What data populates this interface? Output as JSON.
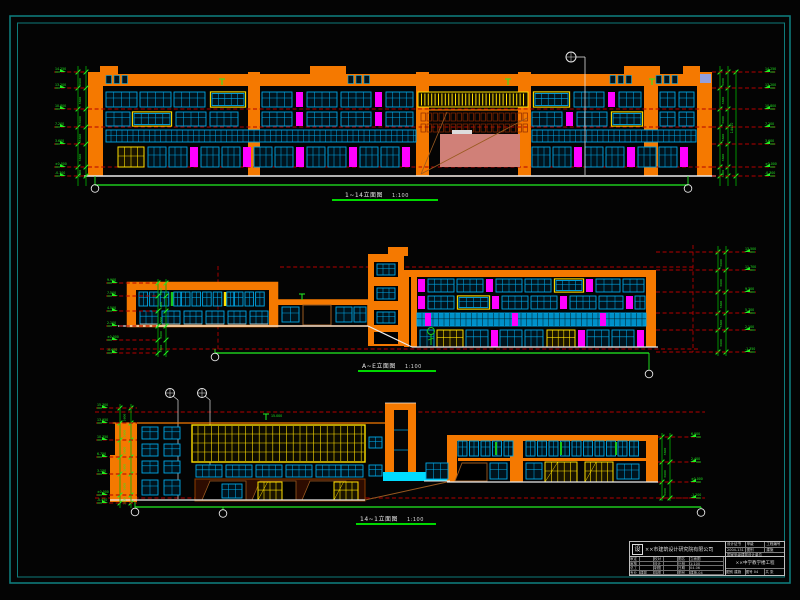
{
  "colors": {
    "orange": "#f57900",
    "cyan": "#00a8e8",
    "cyanBright": "#00dcff",
    "magenta": "#ff00ff",
    "yellow": "#ffe000",
    "green": "#00b400",
    "greenB": "#22ef22",
    "redDash": "#b40000",
    "salmon": "#d08078",
    "brown": "#9a5a20",
    "white": "#ebebeb",
    "frame": "#0e7a7a",
    "background": "#040404",
    "lavender": "#93a0dd",
    "darkWindow": "#00131d",
    "greenSliver": "#19c819",
    "storefront": "#8c3c00"
  },
  "elevations": [
    {
      "name": "front-elevation",
      "title": "1~14立面图",
      "scale": "1:100"
    },
    {
      "name": "courtyard-elevation",
      "title": "A~E立面图",
      "scale": "1:100"
    },
    {
      "name": "rear-elevation",
      "title": "14~1立面图",
      "scale": "1:100"
    }
  ],
  "dims": {
    "floor": "3600",
    "total": "14400",
    "el1_left": [
      "14.250",
      "13.200",
      "10.800",
      "7.200",
      "3.600",
      "±0.000",
      "-0.300"
    ],
    "el1_right": [
      "14.250",
      "13.200",
      "10.800",
      "7.200",
      "3.600",
      "±0.000",
      "-0.300"
    ],
    "el2_left": [
      "9.900",
      "7.500",
      "4.500",
      "2.100",
      "±0.000",
      "-0.600"
    ],
    "el2_right": [
      "13.500",
      "11.700",
      "9.300",
      "5.700",
      "2.100",
      "-1.350"
    ],
    "el3_left": [
      "15.300",
      "13.950",
      "10.350",
      "6.750",
      "3.150",
      "±0.000",
      "-0.450"
    ],
    "el3_right": [
      "6.000",
      "2.400",
      "±0.000",
      "-1.200"
    ],
    "el3_note": "15.000"
  },
  "title_block": {
    "logo": "设",
    "company": "××市建筑设计研究院有限公司",
    "head": [
      [
        "设计证书",
        "甲级",
        "工程编号"
      ],
      [
        "2004-131",
        "图别",
        "建施"
      ]
    ],
    "cert": "国家甲级建筑设计单位",
    "grid_rows": [
      [
        "审定",
        "",
        "校对",
        "",
        "图名",
        "立面图"
      ],
      [
        "审核",
        "",
        "设计",
        "",
        "比例",
        "1:100"
      ],
      [
        "总工",
        "",
        "制图",
        "",
        "日期",
        "04.06"
      ],
      [
        "专业",
        "建筑",
        "描图",
        "",
        "图号",
        "建施-04"
      ]
    ],
    "project": "××中学教学楼工程",
    "sub": [
      "图别 建施",
      "图号 04",
      "共 张"
    ]
  }
}
